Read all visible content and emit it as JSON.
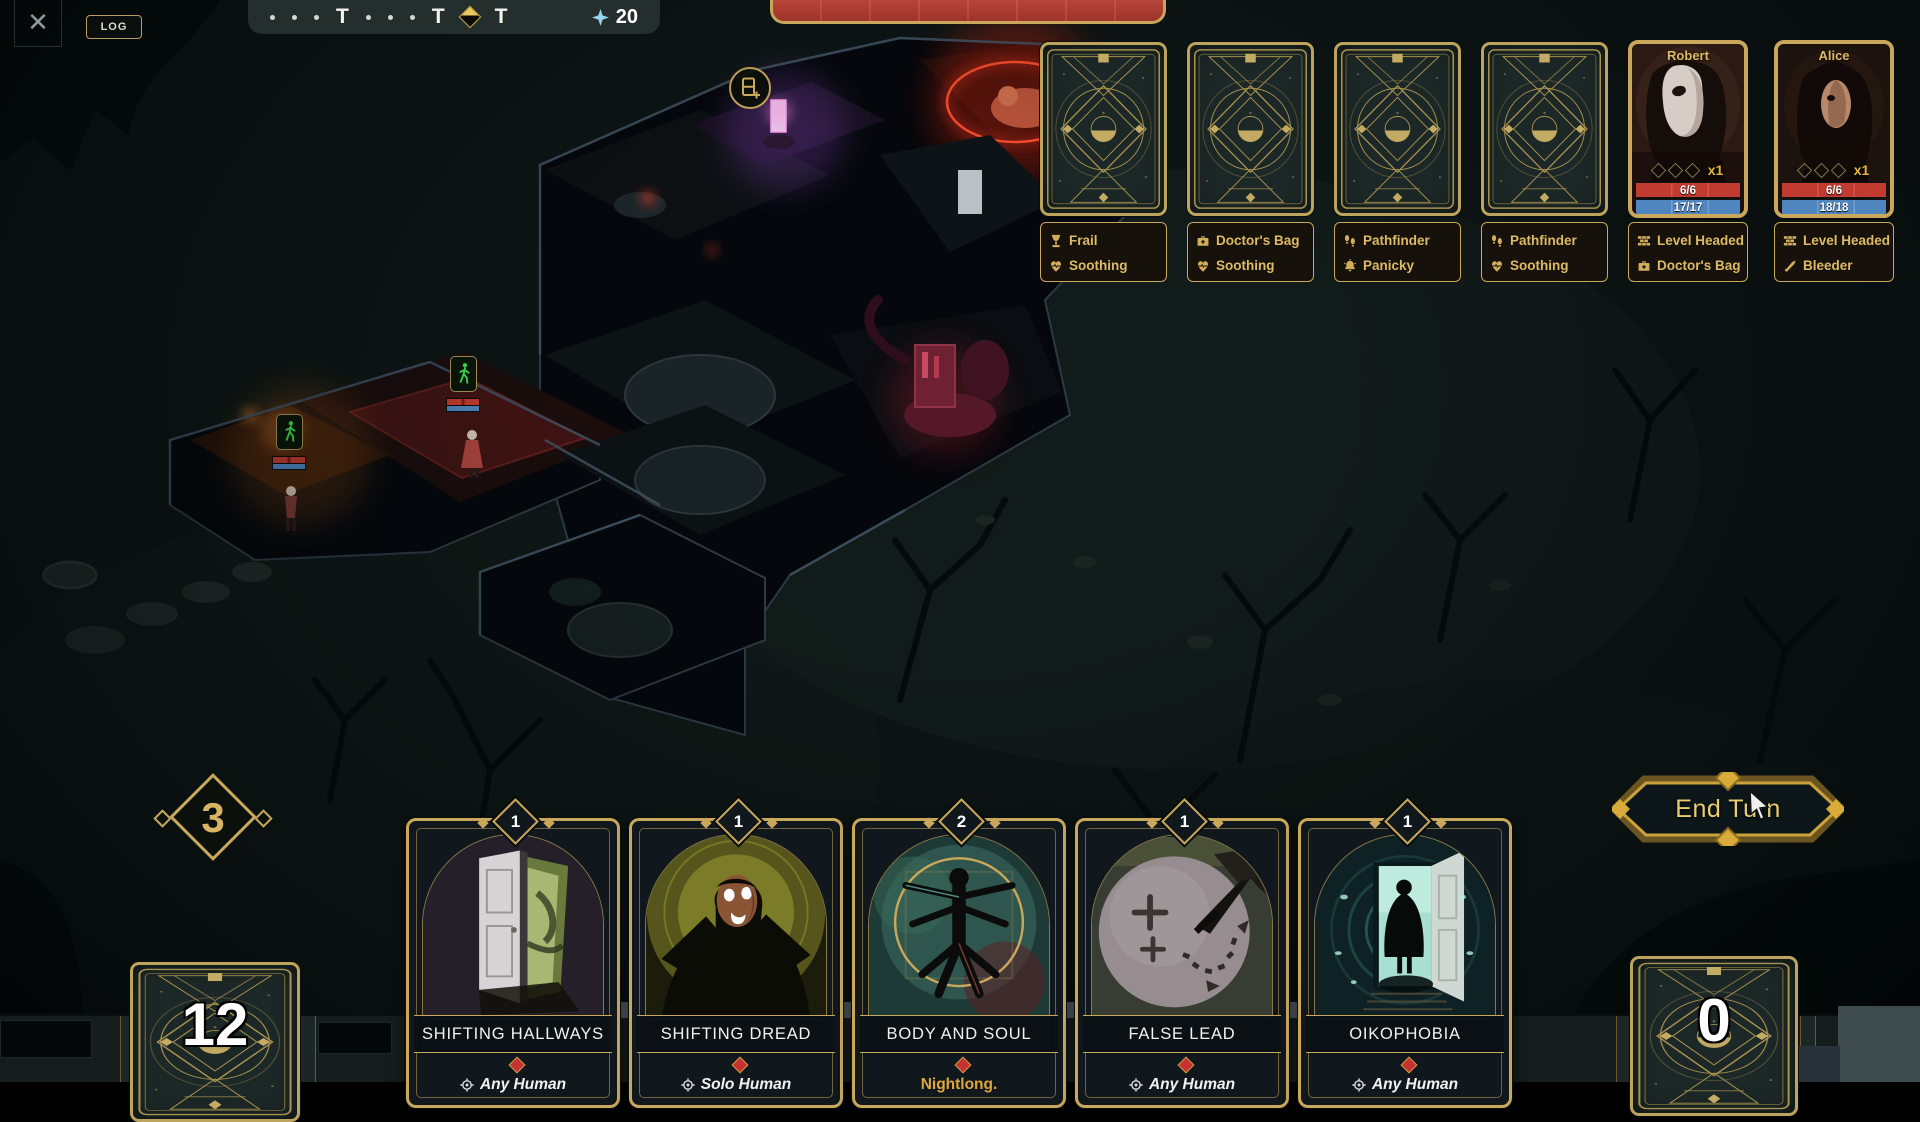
{
  "ui_colors": {
    "gold": "#c9a85c",
    "text_gold": "#ddba65",
    "hp_red": "#c23b30",
    "sanity_blue": "#4f86c0",
    "resource_blue": "#93d6f2",
    "threat_red": "#a93a30"
  },
  "top_left": {
    "close_glyph": "✕",
    "log_label": "LOG"
  },
  "turn_bar": {
    "turn_glyph": "T",
    "items": [
      "dot",
      "dot",
      "dot",
      "turn",
      "dot",
      "dot",
      "dot",
      "turn",
      "current",
      "turn"
    ],
    "resource_icon": "sparkle-icon",
    "resource_value": "20"
  },
  "threat_bar": {
    "segment_count": 8
  },
  "enemy_slots": [
    {
      "traits": [
        {
          "icon": "goblet-icon",
          "label": "Frail"
        },
        {
          "icon": "soothing-heart-icon",
          "label": "Soothing"
        }
      ]
    },
    {
      "traits": [
        {
          "icon": "doctors-bag-icon",
          "label": "Doctor's Bag"
        },
        {
          "icon": "soothing-heart-icon",
          "label": "Soothing"
        }
      ]
    },
    {
      "traits": [
        {
          "icon": "footprints-icon",
          "label": "Pathfinder"
        },
        {
          "icon": "alarm-bell-icon",
          "label": "Panicky"
        }
      ]
    },
    {
      "traits": [
        {
          "icon": "footprints-icon",
          "label": "Pathfinder"
        },
        {
          "icon": "soothing-heart-icon",
          "label": "Soothing"
        }
      ]
    }
  ],
  "characters": [
    {
      "name": "Robert",
      "slots_multiplier": "x1",
      "hp": "6/6",
      "sanity": "17/17",
      "traits": [
        {
          "icon": "brick-wall-icon",
          "label": "Level Headed"
        },
        {
          "icon": "doctors-bag-icon",
          "label": "Doctor's Bag"
        }
      ]
    },
    {
      "name": "Alice",
      "slots_multiplier": "x1",
      "hp": "6/6",
      "sanity": "18/18",
      "traits": [
        {
          "icon": "brick-wall-icon",
          "label": "Level Headed"
        },
        {
          "icon": "knife-icon",
          "label": "Bleeder"
        }
      ]
    }
  ],
  "map": {
    "unit_status_icon": "walking-icon",
    "deck_circle_icon": "card-plus-icon"
  },
  "hand": {
    "action_points": "3",
    "draw_pile_count": "12",
    "discard_pile_count": "0",
    "cards": [
      {
        "cost": "1",
        "title": "SHIFTING HALLWAYS",
        "footer": "Any Human",
        "footer_icon": "target-icon"
      },
      {
        "cost": "1",
        "title": "SHIFTING DREAD",
        "footer": "Solo Human",
        "footer_icon": "target-icon"
      },
      {
        "cost": "2",
        "title": "BODY AND SOUL",
        "footer": "Nightlong.",
        "footer_icon": ""
      },
      {
        "cost": "1",
        "title": "FALSE LEAD",
        "footer": "Any Human",
        "footer_icon": "target-icon"
      },
      {
        "cost": "1",
        "title": "OIKOPHOBIA",
        "footer": "Any Human",
        "footer_icon": "target-icon"
      }
    ]
  },
  "end_turn": {
    "label": "End Turn"
  }
}
